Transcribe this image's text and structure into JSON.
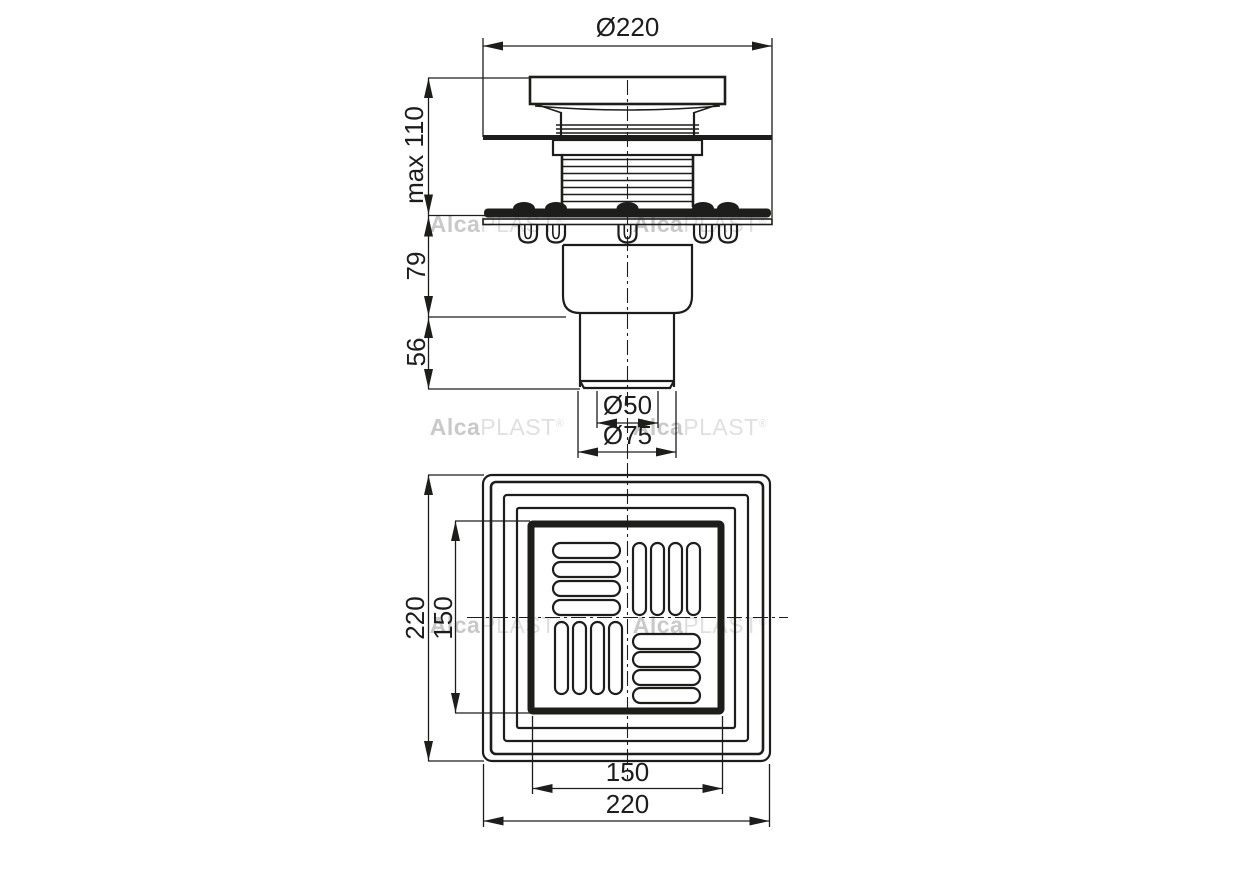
{
  "drawing": {
    "side_view": {
      "dim_top_width": "Ø220",
      "dim_height_max": "max 110",
      "dim_mid_height": "79",
      "dim_outlet_height": "56",
      "dim_outlet_inner_diameter": "Ø50",
      "dim_outlet_outer_diameter": "Ø75"
    },
    "plan_view": {
      "dim_left_outer": "220",
      "dim_left_inner": "150",
      "dim_bottom_inner": "150",
      "dim_bottom_outer": "220"
    }
  },
  "watermark": {
    "brand": "Alca",
    "brand_suffix": "PLAST",
    "registered_mark": "®"
  },
  "colors": {
    "line": "#1d1d1b",
    "watermark_bold": "#c9c9c9",
    "watermark_light": "#e0e0e0",
    "background": "#ffffff"
  }
}
